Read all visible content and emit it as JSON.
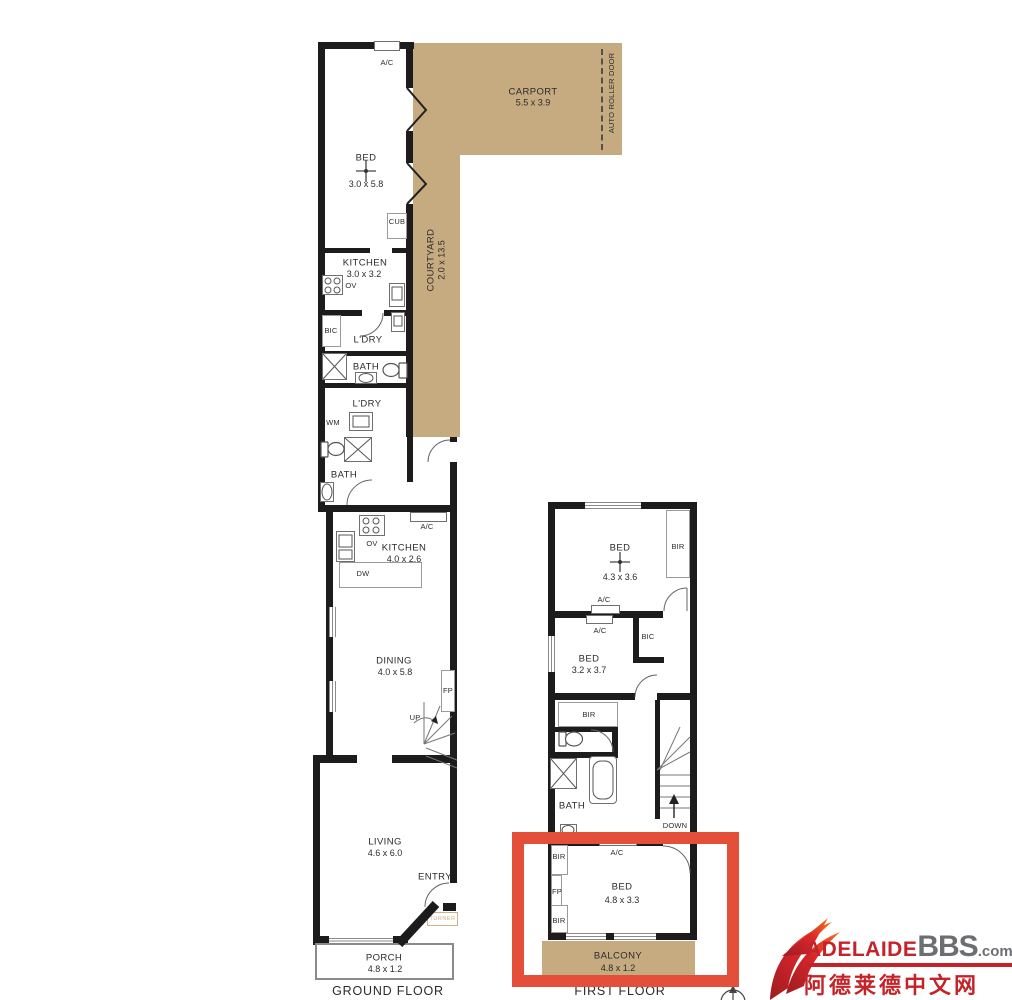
{
  "colors": {
    "tan": "#c6aa80",
    "wall": "#1c1c1c",
    "highlight": "#e34f38",
    "logo_red": "#c4232a",
    "logo_gray": "#6d6e71"
  },
  "gf": {
    "caption": "GROUND FLOOR",
    "ac_top": "A/C",
    "bed1": {
      "name": "BED",
      "dims": "3.0 x 5.8"
    },
    "carport": {
      "name": "CARPORT",
      "dims": "5.5 x 3.9"
    },
    "roller": "AUTO ROLLER DOOR",
    "courtyard": {
      "name": "COURTYARD",
      "dims": "2.0 x 13.5"
    },
    "cub": "CUB",
    "kitchen1": {
      "name": "KITCHEN",
      "dims": "3.0 x 3.2"
    },
    "ov1": "OV",
    "bic": "BIC",
    "ldry1": "L'DRY",
    "bath1": "BATH",
    "ldry2": "L'DRY",
    "wm": "WM",
    "bath2": "BATH",
    "ac_mid": "A/C",
    "ov2": "OV",
    "dw": "DW",
    "kitchen2": {
      "name": "KITCHEN",
      "dims": "4.0 x 2.6"
    },
    "dining": {
      "name": "DINING",
      "dims": "4.0 x 5.8"
    },
    "fp": "FP",
    "up": "UP",
    "living": {
      "name": "LIVING",
      "dims": "4.6 x 6.0"
    },
    "entry": "ENTRY",
    "turner": "TURNER",
    "porch": {
      "name": "PORCH",
      "dims": "4.8 x 1.2"
    }
  },
  "ff": {
    "caption": "FIRST FLOOR",
    "bed1": {
      "name": "BED",
      "dims": "4.3 x 3.6"
    },
    "bir1": "BIR",
    "ac1": "A/C",
    "ac2": "A/C",
    "bic": "BIC",
    "bed2": {
      "name": "BED",
      "dims": "3.2 x 3.7"
    },
    "bir2": "BIR",
    "bath": "BATH",
    "down": "DOWN",
    "bir3": "BIR",
    "ac3": "A/C",
    "fp": "FP",
    "bir4": "BIR",
    "bed3": {
      "name": "BED",
      "dims": "4.8 x 3.3"
    },
    "balcony": {
      "name": "BALCONY",
      "dims": "4.8 x 1.2"
    }
  },
  "watermark": {
    "brand_adelaide": "ADELAIDE",
    "brand_bbs": "BBS",
    "brand_com": ".com",
    "tagline": "阿德莱德中文网"
  }
}
